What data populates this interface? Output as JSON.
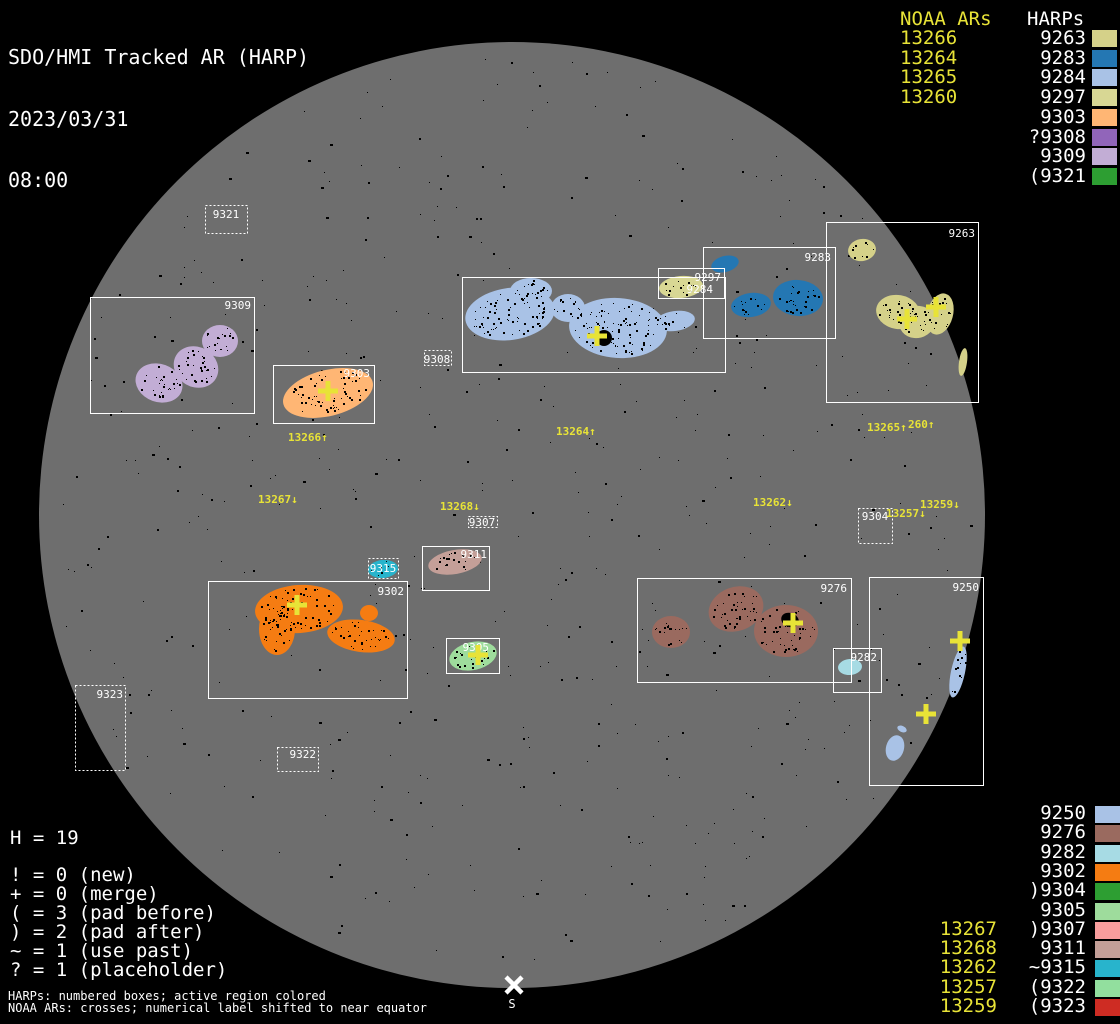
{
  "header": {
    "title": "SDO/HMI Tracked AR (HARP)",
    "date": "2023/03/31",
    "time": "08:00"
  },
  "colors": {
    "background": "#000000",
    "disk": "#6e6e6e",
    "box_stroke": "#ffffff",
    "harp_label": "#ffffff",
    "noaa_yellow": "#e8e337"
  },
  "legend_top": {
    "noaa_heading": "NOAA ARs",
    "harp_heading": "HARPs",
    "rows": [
      {
        "noaa": "13266",
        "harp": "9263",
        "color": "#d5d189"
      },
      {
        "noaa": "13264",
        "harp": "9283",
        "color": "#2477b3"
      },
      {
        "noaa": "13265",
        "harp": "9284",
        "color": "#a9c2e6"
      },
      {
        "noaa": "13260",
        "harp": "9297",
        "color": "#d8d794"
      },
      {
        "noaa": "",
        "harp": "9303",
        "color": "#ffb674"
      },
      {
        "noaa": "",
        "harp": "?9308",
        "color": "#9165ba"
      },
      {
        "noaa": "",
        "harp": "9309",
        "color": "#c2add5"
      },
      {
        "noaa": "",
        "harp": "(9321",
        "color": "#2d9e32"
      }
    ]
  },
  "legend_bottom_right": {
    "rows": [
      {
        "noaa": "",
        "harp": "9250",
        "color": "#a9c2e6"
      },
      {
        "noaa": "",
        "harp": "9276",
        "color": "#9a6a5f"
      },
      {
        "noaa": "",
        "harp": "9282",
        "color": "#a7dbe4"
      },
      {
        "noaa": "",
        "harp": "9302",
        "color": "#f57c12"
      },
      {
        "noaa": "",
        "harp": ")9304",
        "color": "#2d9e32"
      },
      {
        "noaa": "",
        "harp": "9305",
        "color": "#9edc9c"
      },
      {
        "noaa": "13267",
        "harp": ")9307",
        "color": "#f99d9d"
      },
      {
        "noaa": "13268",
        "harp": "9311",
        "color": "#c49f98"
      },
      {
        "noaa": "13262",
        "harp": "~9315",
        "color": "#28b4cc"
      },
      {
        "noaa": "13257",
        "harp": "(9322",
        "color": "#92df9e"
      },
      {
        "noaa": "13259",
        "harp": "(9323",
        "color": "#ce2c23"
      }
    ]
  },
  "legend_bottom_left": {
    "harp_count": "H = 19",
    "flags": [
      "! = 0 (new)",
      "+ = 0 (merge)",
      "( = 3 (pad before)",
      ") = 2 (pad after)",
      "~ = 1 (use past)",
      "? = 1 (placeholder)"
    ],
    "footnote1": "HARPs: numbered boxes; active region colored",
    "footnote2": "NOAA ARs: crosses; numerical label shifted to near equator"
  },
  "chart_data": {
    "type": "scatter",
    "subtype": "solar-full-disk-harp-map",
    "title": "SDO/HMI Tracked AR (HARP) 2023/03/31 08:00",
    "disk": {
      "cx": 512,
      "cy": 515,
      "r": 473
    },
    "regions": [
      {
        "harp": "9263",
        "noaa": [
          "13265",
          "13260"
        ],
        "color": "#d5d189",
        "box": [
          826,
          222,
          152,
          180
        ],
        "box_style": "solid",
        "label_anchor": [
          975,
          237,
          "end"
        ]
      },
      {
        "harp": "9283",
        "noaa": [],
        "color": "#2477b3",
        "box": [
          703,
          247,
          132,
          91
        ],
        "box_style": "solid",
        "label_anchor": [
          831,
          261,
          "end"
        ]
      },
      {
        "harp": "9284",
        "noaa": [
          "13264"
        ],
        "color": "#a9c2e6",
        "box": [
          462,
          277,
          263,
          95
        ],
        "box_style": "solid",
        "label_anchor": [
          713,
          293,
          "end"
        ]
      },
      {
        "harp": "9297",
        "noaa": [],
        "color": "#d8d794",
        "box": [
          658,
          268,
          66,
          30
        ],
        "box_style": "solid",
        "label_anchor": [
          721,
          281,
          "end"
        ]
      },
      {
        "harp": "9303",
        "noaa": [
          "13266"
        ],
        "color": "#ffb674",
        "box": [
          273,
          365,
          101,
          58
        ],
        "box_style": "solid",
        "label_anchor": [
          370,
          377,
          "end"
        ]
      },
      {
        "harp": "9308",
        "noaa": [],
        "color": "#9165ba",
        "box": [
          424,
          350,
          27,
          15
        ],
        "box_style": "dotted",
        "label_anchor": [
          437,
          363,
          "middle"
        ]
      },
      {
        "harp": "9309",
        "noaa": [],
        "color": "#c2add5",
        "box": [
          90,
          297,
          164,
          116
        ],
        "box_style": "solid",
        "label_anchor": [
          251,
          309,
          "end"
        ]
      },
      {
        "harp": "9321",
        "noaa": [],
        "color": "#2d9e32",
        "box": [
          205,
          205,
          42,
          28
        ],
        "box_style": "dotted",
        "label_anchor": [
          226,
          218,
          "middle"
        ]
      },
      {
        "harp": "9250",
        "noaa": [
          "13257",
          "13259"
        ],
        "color": "#a9c2e6",
        "box": [
          869,
          577,
          114,
          208
        ],
        "box_style": "solid",
        "label_anchor": [
          979,
          591,
          "end"
        ]
      },
      {
        "harp": "9276",
        "noaa": [
          "13262"
        ],
        "color": "#9a6a5f",
        "box": [
          637,
          578,
          214,
          104
        ],
        "box_style": "solid",
        "label_anchor": [
          847,
          592,
          "end"
        ]
      },
      {
        "harp": "9282",
        "noaa": [],
        "color": "#a7dbe4",
        "box": [
          833,
          648,
          48,
          44
        ],
        "box_style": "solid",
        "label_anchor": [
          877,
          661,
          "end"
        ]
      },
      {
        "harp": "9302",
        "noaa": [
          "13267"
        ],
        "color": "#f57c12",
        "box": [
          208,
          581,
          199,
          117
        ],
        "box_style": "solid",
        "label_anchor": [
          404,
          595,
          "end"
        ]
      },
      {
        "harp": "9304",
        "noaa": [],
        "color": "#2d9e32",
        "box": [
          858,
          508,
          34,
          35
        ],
        "box_style": "dotted",
        "label_anchor": [
          875,
          520,
          "middle"
        ]
      },
      {
        "harp": "9305",
        "noaa": [
          "13268"
        ],
        "color": "#9edc9c",
        "box": [
          446,
          638,
          53,
          35
        ],
        "box_style": "solid",
        "label_anchor": [
          489,
          651,
          "end"
        ]
      },
      {
        "harp": "9307",
        "noaa": [],
        "color": "#f99d9d",
        "box": [
          468,
          516,
          29,
          11
        ],
        "box_style": "dotted",
        "label_anchor": [
          482,
          526,
          "middle"
        ]
      },
      {
        "harp": "9311",
        "noaa": [],
        "color": "#c49f98",
        "box": [
          422,
          546,
          67,
          44
        ],
        "box_style": "solid",
        "label_anchor": [
          487,
          558,
          "end"
        ]
      },
      {
        "harp": "9315",
        "noaa": [],
        "color": "#28b4cc",
        "box": [
          368,
          558,
          30,
          20
        ],
        "box_style": "dotted",
        "label_anchor": [
          383,
          572,
          "middle"
        ]
      },
      {
        "harp": "9322",
        "noaa": [],
        "color": "#92df9e",
        "box": [
          277,
          747,
          41,
          24
        ],
        "box_style": "dotted",
        "label_anchor": [
          316,
          758,
          "end"
        ]
      },
      {
        "harp": "9323",
        "noaa": [],
        "color": "#ce2c23",
        "box": [
          75,
          685,
          50,
          85
        ],
        "box_style": "dotted",
        "label_anchor": [
          123,
          698,
          "end"
        ]
      }
    ],
    "crosses": [
      [
        597,
        336
      ],
      [
        328,
        391
      ],
      [
        297,
        605
      ],
      [
        793,
        623
      ],
      [
        907,
        319
      ],
      [
        936,
        307
      ],
      [
        960,
        641
      ],
      [
        926,
        714
      ],
      [
        478,
        655
      ]
    ],
    "noaa_disk_labels": [
      {
        "text": "13266↑",
        "x": 288,
        "y": 441
      },
      {
        "text": "13264↑",
        "x": 556,
        "y": 435
      },
      {
        "text": "13265↑",
        "x": 867,
        "y": 431
      },
      {
        "text": "260↑",
        "x": 908,
        "y": 428
      },
      {
        "text": "13267↓",
        "x": 258,
        "y": 503
      },
      {
        "text": "13268↓",
        "x": 440,
        "y": 510
      },
      {
        "text": "13262↓",
        "x": 753,
        "y": 506
      },
      {
        "text": "13257↓",
        "x": 886,
        "y": 517
      },
      {
        "text": "13259↓",
        "x": 920,
        "y": 508
      }
    ],
    "south_marker": {
      "x": 514,
      "y": 985,
      "label": "S"
    }
  }
}
